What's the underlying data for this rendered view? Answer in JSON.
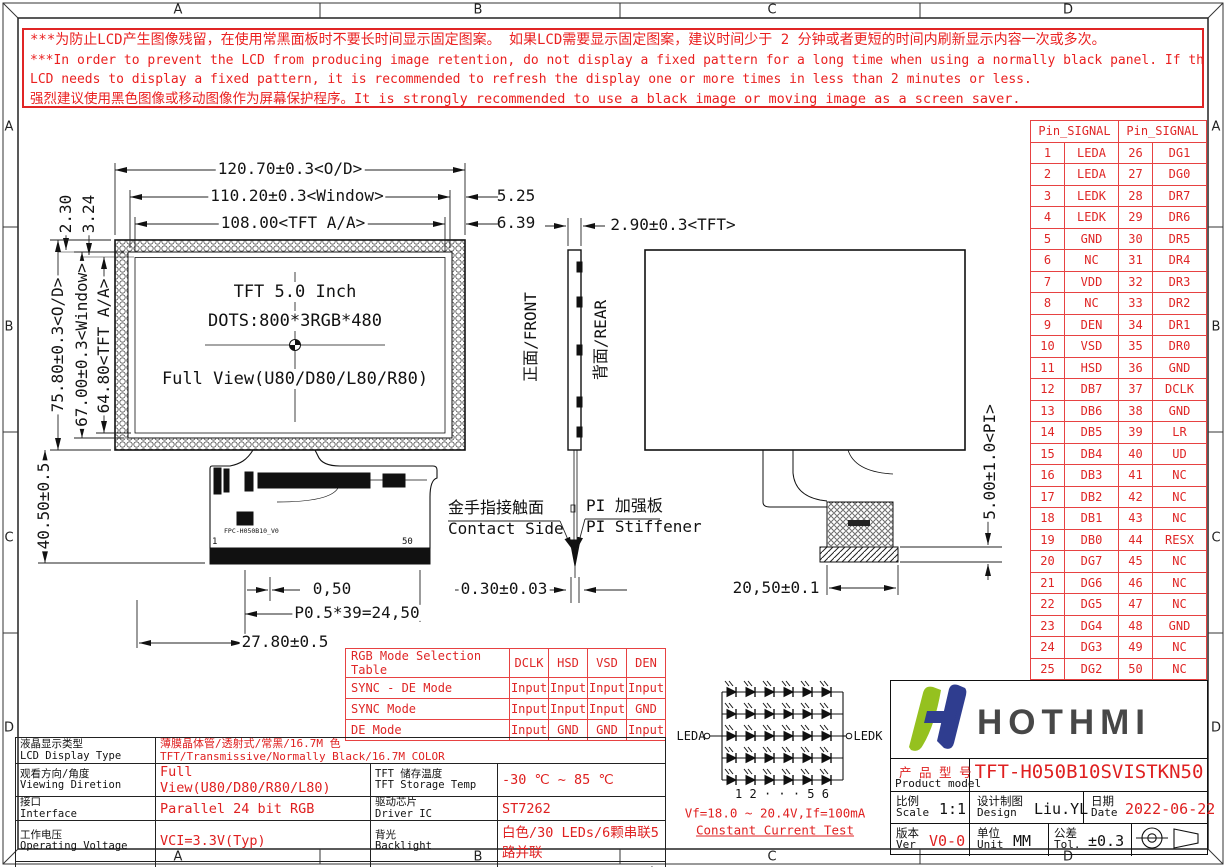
{
  "frame": {
    "zone_letters": [
      "A",
      "B",
      "C",
      "D"
    ]
  },
  "warning": {
    "line1": "***为防止LCD产生图像残留，在使用常黑面板时不要长时间显示固定图案。 如果LCD需要显示固定图案，建议时间少于 2 分钟或者更短的时间内刷新显示内容一次或多次。",
    "line2": "***In order to prevent the LCD from producing image retention, do not display a fixed pattern for a long time when using a normally black panel. If the",
    "line3": " LCD needs to display a fixed pattern, it is recommended to refresh the display one or more times in less than 2 minutes or less.",
    "line4": "强烈建议使用黑色图像或移动图像作为屏幕保护程序。It is strongly recommended to use a black image or moving image as a screen saver."
  },
  "front_view": {
    "size_line": "TFT 5.0 Inch",
    "dots_line": "DOTS:800*3RGB*480",
    "view_line": "Full View(U80/D80/L80/R80)",
    "fpc_label": "FPC-H050B10_V0",
    "pin_first": "1",
    "pin_last": "50"
  },
  "dimensions": {
    "od_w": "120.70±0.3<O/D>",
    "window_w": "110.20±0.3<Window>",
    "aa_w": "108.00<TFT A/A>",
    "d525": "5.25",
    "d639": "6.39",
    "d230": "2.30",
    "d324": "3.24",
    "od_h": "75.80±0.3<O/D>",
    "window_h": "67.00±0.3<Window>",
    "aa_h": "64.80<TFT A/A>",
    "d4050": "40.50±0.5",
    "d050": "0,50",
    "pitch": "P0.5*39=24,50",
    "d2780": "27.80±0.5",
    "tft_t": "2.90±0.3<TFT>",
    "d030": "0.30±0.03",
    "d2050": "20,50±0.1",
    "pi_t": "5.00±1.0<PI>"
  },
  "side_view": {
    "front_label": "正面/FRONT",
    "rear_label": "背面/REAR",
    "contact_zh": "金手指接触面",
    "contact_en": "Contact Side",
    "stiffener_zh": "PI 加强板",
    "stiffener_en": "PI Stiffener"
  },
  "pin_table": {
    "header": "Pin_SIGNAL",
    "rows": [
      [
        "1",
        "LEDA",
        "26",
        "DG1"
      ],
      [
        "2",
        "LEDA",
        "27",
        "DG0"
      ],
      [
        "3",
        "LEDK",
        "28",
        "DR7"
      ],
      [
        "4",
        "LEDK",
        "29",
        "DR6"
      ],
      [
        "5",
        "GND",
        "30",
        "DR5"
      ],
      [
        "6",
        "NC",
        "31",
        "DR4"
      ],
      [
        "7",
        "VDD",
        "32",
        "DR3"
      ],
      [
        "8",
        "NC",
        "33",
        "DR2"
      ],
      [
        "9",
        "DEN",
        "34",
        "DR1"
      ],
      [
        "10",
        "VSD",
        "35",
        "DR0"
      ],
      [
        "11",
        "HSD",
        "36",
        "GND"
      ],
      [
        "12",
        "DB7",
        "37",
        "DCLK"
      ],
      [
        "13",
        "DB6",
        "38",
        "GND"
      ],
      [
        "14",
        "DB5",
        "39",
        "LR"
      ],
      [
        "15",
        "DB4",
        "40",
        "UD"
      ],
      [
        "16",
        "DB3",
        "41",
        "NC"
      ],
      [
        "17",
        "DB2",
        "42",
        "NC"
      ],
      [
        "18",
        "DB1",
        "43",
        "NC"
      ],
      [
        "19",
        "DB0",
        "44",
        "RESX"
      ],
      [
        "20",
        "DG7",
        "45",
        "NC"
      ],
      [
        "21",
        "DG6",
        "46",
        "NC"
      ],
      [
        "22",
        "DG5",
        "47",
        "NC"
      ],
      [
        "23",
        "DG4",
        "48",
        "GND"
      ],
      [
        "24",
        "DG3",
        "49",
        "NC"
      ],
      [
        "25",
        "DG2",
        "50",
        "NC"
      ]
    ]
  },
  "rgb_table": {
    "title": "RGB Mode Selection Table",
    "cols": [
      "DCLK",
      "HSD",
      "VSD",
      "DEN"
    ],
    "rows": [
      {
        "label": "SYNC - DE Mode",
        "values": [
          "Input",
          "Input",
          "Input",
          "Input"
        ]
      },
      {
        "label": "SYNC Mode",
        "values": [
          "Input",
          "Input",
          "Input",
          "GND"
        ]
      },
      {
        "label": "DE Mode",
        "values": [
          "Input",
          "GND",
          "GND",
          "Input"
        ]
      }
    ]
  },
  "led": {
    "anode": "LEDA",
    "cathode": "LEDK",
    "index_row": "1 2 · · · 5 6",
    "spec": "Vf=18.0 ~ 20.4V,If=100mA",
    "test": "Constant Current Test"
  },
  "spec_table": {
    "row1": {
      "zh": "液晶显示类型",
      "en": "LCD Display Type",
      "v1": "薄膜晶体管/透射式/常黑/16.7M 色",
      "v2": "TFT/Transmissive/Normally Black/16.7M COLOR"
    },
    "rows": [
      {
        "l_zh": "观看方向/角度",
        "l_en": "Viewing Diretion",
        "l_val": "Full View(U80/D80/R80/L80)",
        "r_zh": "TFT 储存温度",
        "r_en": "TFT Storage Temp",
        "r_val": "-30 ℃ ~ 85 ℃"
      },
      {
        "l_zh": "接口",
        "l_en": "Interface",
        "l_val": "Parallel 24 bit RGB",
        "r_zh": "驱动芯片",
        "r_en": "Driver IC",
        "r_val": "ST7262"
      },
      {
        "l_zh": "工作电压",
        "l_en": "Operating Voltage",
        "l_val": "VCI=3.3V(Typ)",
        "r_zh": "背光",
        "r_en": "Backlight",
        "r_val": "白色/30 LEDs/6颗串联5路并联"
      },
      {
        "l_zh": "TFT 工作温度",
        "l_en": "TFT Operating Temp",
        "l_val": "-30 ℃ ~ 80 ℃",
        "r_zh": "液晶模组亮度",
        "r_en": "LCM Brightness",
        "r_val_red": "1000",
        "r_val_black": " cd/m²(Typ)/固定电流测试"
      }
    ]
  },
  "title_block": {
    "brand": "HOTHMI",
    "model_label_zh": "产 品 型 号",
    "model_label_en": "Product model",
    "model": "TFT-H050B10SVISTKN50",
    "scale_zh": "比例",
    "scale_en": "Scale",
    "scale": "1:1",
    "design_zh": "设计制图",
    "design_en": "Design",
    "designer": "Liu.YL",
    "date_zh": "日期",
    "date_en": "Date",
    "date": "2022-06-22",
    "ver_zh": "版本",
    "ver_en": "Ver",
    "ver": "V0-0",
    "unit_zh": "单位",
    "unit_en": "Unit",
    "unit": "MM",
    "tol_zh": "公差",
    "tol_en": "Tol.",
    "tol": "±0.3"
  },
  "colors": {
    "red": "#df2626",
    "logo_green": "#95c11f",
    "logo_navy": "#2f3d8f"
  }
}
